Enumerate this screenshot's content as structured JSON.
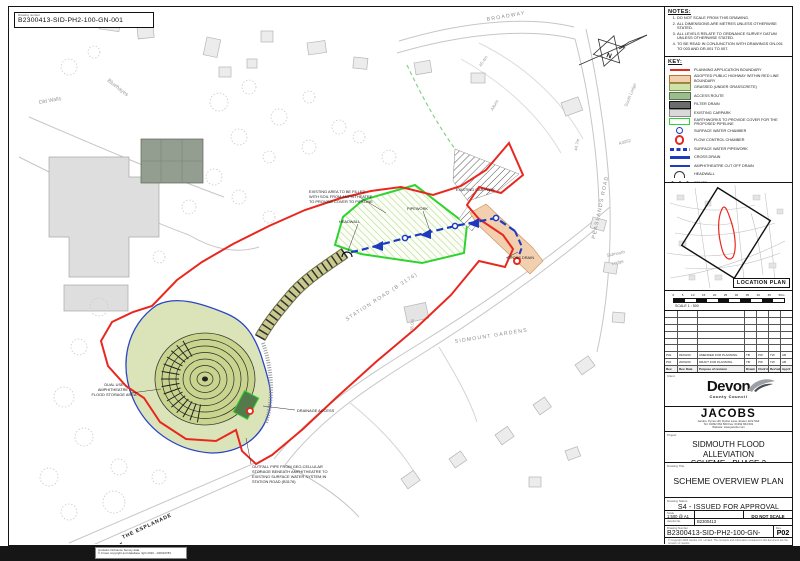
{
  "sheet": {
    "drawing_number_box": {
      "label": "Drawing number",
      "value": "B2300413-SID-PH2-100-GN-001"
    }
  },
  "notes": {
    "title": "NOTES:",
    "items": [
      "DO NOT SCALE FROM THIS DRAWING.",
      "ALL DIMENSIONS ARE METRES UNLESS OTHERWISE STATED.",
      "ALL LEVELS RELATE TO ORDNANCE SURVEY DATUM UNLESS OTHERWISE STATED.",
      "TO BE READ IN CONJUNCTION WITH DRAWINGS GN-001 TO 003 AND DR-001 TO 007."
    ]
  },
  "key": {
    "title": "KEY:",
    "items": [
      {
        "symbol": "red-line",
        "label": "PLANNING APPLICATION BOUNDARY"
      },
      {
        "symbol": "peach-fill",
        "label": "ADOPTED PUBLIC HIGHWAY WITHIN RED LINE BOUNDARY"
      },
      {
        "symbol": "light-green-fill",
        "label": "GRASSED (UNDER GRASSCRETE)"
      },
      {
        "symbol": "green-fill",
        "label": "ACCESS ROUTE"
      },
      {
        "symbol": "speckled-fill",
        "label": "FILTER DRAIN"
      },
      {
        "symbol": "grey-fill",
        "label": "EXISTING CARPARK"
      },
      {
        "symbol": "green-outline",
        "label": "EARTHWORKS TO PROVIDE COVER FOR THE PROPOSED PIPELINE"
      },
      {
        "symbol": "blue-donut",
        "label": "SURFACE WATER CHAMBER"
      },
      {
        "symbol": "red-donut",
        "label": "FLOW CONTROL CHAMBER"
      },
      {
        "symbol": "blue-dashed-line",
        "label": "SURFACE WATER PIPEWORK"
      },
      {
        "symbol": "blue-thick-line",
        "label": "CROSS DRAIN"
      },
      {
        "symbol": "blue-thin-line",
        "label": "AMPHITHEATRE CUT OFF DRAIN"
      },
      {
        "symbol": "arc",
        "label": "HEADWALL"
      },
      {
        "symbol": "post-line",
        "label": "FENCE"
      }
    ]
  },
  "location_plan": {
    "label": "LOCATION PLAN"
  },
  "scale_bar": {
    "ticks": [
      "0",
      "5",
      "10",
      "15",
      "20",
      "25",
      "30",
      "35",
      "40",
      "45",
      "50m"
    ],
    "caption": "SCALE 1 : 500"
  },
  "revision_table": {
    "headers": [
      "Rev.",
      "Rev. Date",
      "Purpose of revision",
      "Drawn",
      "Chck'd",
      "Rev'wd",
      "App'd"
    ],
    "rows": [
      {
        "rev": "P02",
        "date": "03/04/20",
        "purpose": "AMENDED FOR PLANNING",
        "drawn": "TB",
        "checked": "PW",
        "reviewed": "TW",
        "approved": "AB"
      },
      {
        "rev": "P01",
        "date": "20/03/20",
        "purpose": "DRAFT FOR PLANNING",
        "drawn": "TB",
        "checked": "PW",
        "reviewed": "TW",
        "approved": "AB"
      }
    ]
  },
  "logos": {
    "client_label": "Client",
    "devon": {
      "name": "Devon",
      "sub": "County Council"
    },
    "jacobs": {
      "name": "JACOBS",
      "address1": "Jacobs, Pynes Hill, Rydon Lane, Exeter, EX2 5AZ",
      "address2": "Tel: 01392 664 600  Fax: 01392 664 601",
      "address3": "Website: www.jacobs.com"
    }
  },
  "title_block": {
    "project_label": "Project",
    "project": "SIDMOUTH FLOOD ALLEVIATION\nSCHEME - PHASE 2",
    "drawing_title_label": "Drawing Title",
    "drawing_title": "SCHEME OVERVIEW PLAN",
    "status_label": "Drawing Status",
    "status": "S4 - ISSUED FOR APPROVAL",
    "scale_label": "Scale",
    "scale": "1:500 @ A1",
    "do_not_scale": "DO NOT SCALE",
    "jacobs_no_label": "Jacobs No.",
    "jacobs_no": "B2300413",
    "drawing_no_label": "Drawing Number",
    "drawing_no": "B2300413-SID-PH2-100-GN-001",
    "rev_label": "Rev.",
    "rev": "P02",
    "small_print_1": "© Copyright 2020 Jacobs U.K. Limited. The concepts and information contained in this document are the property of Jacobs.",
    "small_print_2": "Use or copying of this document in whole or in part without the written permission of Jacobs constitutes an infringement of copyright."
  },
  "footer": {
    "os_credit_1": "Contains Ordnance Survey data",
    "os_credit_2": "© Crown copyright and database right 2020 - 100019783"
  },
  "colors": {
    "boundary_red": "#e8281e",
    "earthworks_green": "#2fd32f",
    "pipework_blue": "#1d3bc0",
    "highway_peach": "#f2cfae",
    "grassed_green": "#cfe3a9",
    "access_green": "#9dbd8e",
    "amphitheatre_fill": "#c9d48e",
    "base_grey": "#c9c9c9"
  },
  "map": {
    "labels": [
      {
        "text": "Old Walls"
      },
      {
        "text": "Bluehayes"
      },
      {
        "text": "BROADWAY"
      },
      {
        "text": "45.4m"
      },
      {
        "text": "Altura"
      },
      {
        "text": "South Lodge"
      },
      {
        "text": "A3052"
      },
      {
        "text": "44.7m"
      },
      {
        "text": "PEASLANDS ROAD"
      },
      {
        "text": "Sidmouth"
      },
      {
        "text": "Lodge"
      },
      {
        "text": "EXISTING CAR PARK"
      },
      {
        "text": "EXISTING AREA TO BE FILLED"
      },
      {
        "text": "WITH SOIL FROM AMPHITHEATRE"
      },
      {
        "text": "TO PROVIDE COVER TO PIPELINE"
      },
      {
        "text": "PIPEWORK"
      },
      {
        "text": "HEADWALL"
      },
      {
        "text": "CROSS DRAIN"
      },
      {
        "text": "STATION ROAD (B 3176)"
      },
      {
        "text": "36.0m"
      },
      {
        "text": "SIDMOUNT GARDENS"
      },
      {
        "text": "DUAL USE"
      },
      {
        "text": "AMPHITHEATRE /"
      },
      {
        "text": "FLOOD STORAGE AREA"
      },
      {
        "text": "DRAINAGE ACCESS"
      },
      {
        "text": "OUTFALL PIPE FROM GEO-CELLULAR"
      },
      {
        "text": "STORAGE BENEATH AMPHITHEATRE TO"
      },
      {
        "text": "EXISTING SURFACE WATER SYSTEM IN"
      },
      {
        "text": "STATION ROAD (B3176)"
      },
      {
        "text": "THE ESPLANADE"
      },
      {
        "text": "N"
      }
    ]
  }
}
